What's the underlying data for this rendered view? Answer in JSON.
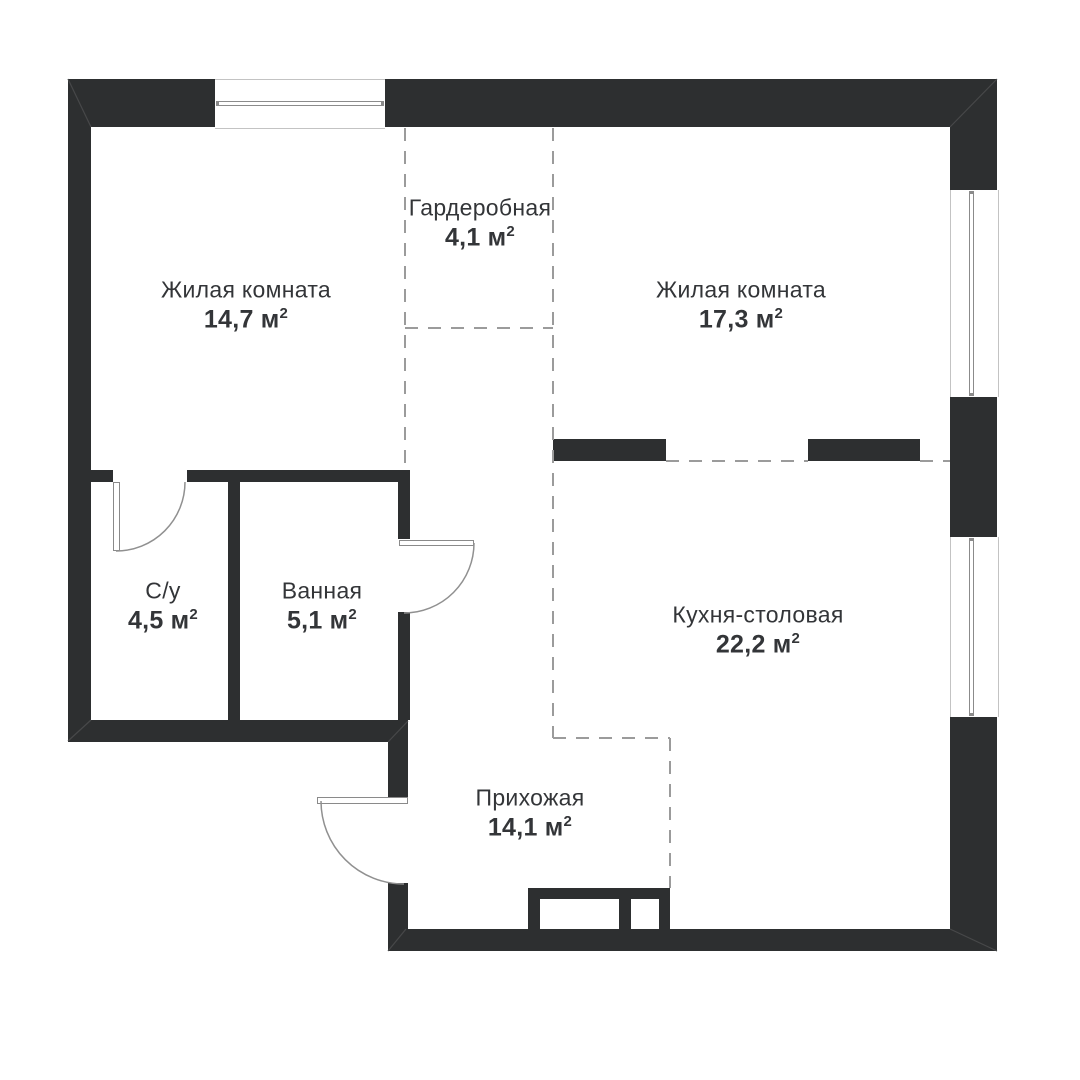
{
  "plan": {
    "title": "apartment-floor-plan",
    "colors": {
      "wall": "#2d2f30",
      "dashed_line": "#9b9b9b",
      "text": "#333538",
      "window_frame": "#8b8b8b",
      "background": "#ffffff"
    },
    "area_unit": "м",
    "area_sup": "2",
    "rooms": [
      {
        "name": "Жилая комната",
        "area": "14,7"
      },
      {
        "name": "Гардеробная",
        "area": "4,1"
      },
      {
        "name": "Жилая комната",
        "area": "17,3"
      },
      {
        "name": "С/у",
        "area": "4,5"
      },
      {
        "name": "Ванная",
        "area": "5,1"
      },
      {
        "name": "Кухня-столовая",
        "area": "22,2"
      },
      {
        "name": "Прихожая",
        "area": "14,1"
      }
    ]
  }
}
